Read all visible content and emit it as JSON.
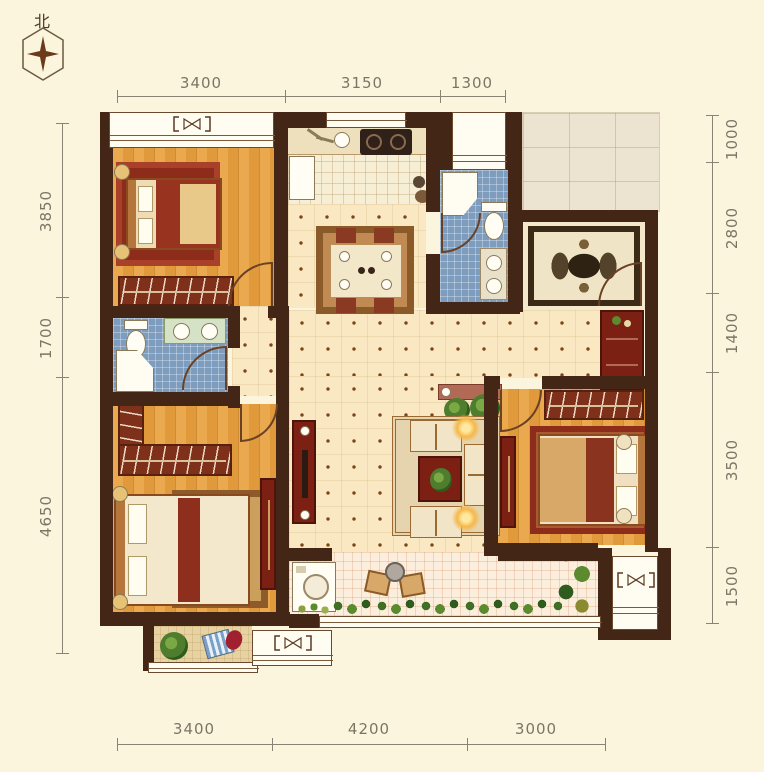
{
  "compass": {
    "label": "北"
  },
  "dimensions": {
    "top": [
      "3400",
      "3150",
      "1300"
    ],
    "bottom": [
      "3400",
      "4200",
      "3000"
    ],
    "left": [
      "3850",
      "1700",
      "4650"
    ],
    "right": [
      "1000",
      "2800",
      "1400",
      "3500",
      "1500"
    ]
  },
  "colors": {
    "wall": "#432616",
    "wood_floor": "#e6a344",
    "tile_floor": "#f9e8c2",
    "bath_tile": "#7e9dbe",
    "furniture_red": "#7c2014",
    "background": "#fcf5dd"
  }
}
